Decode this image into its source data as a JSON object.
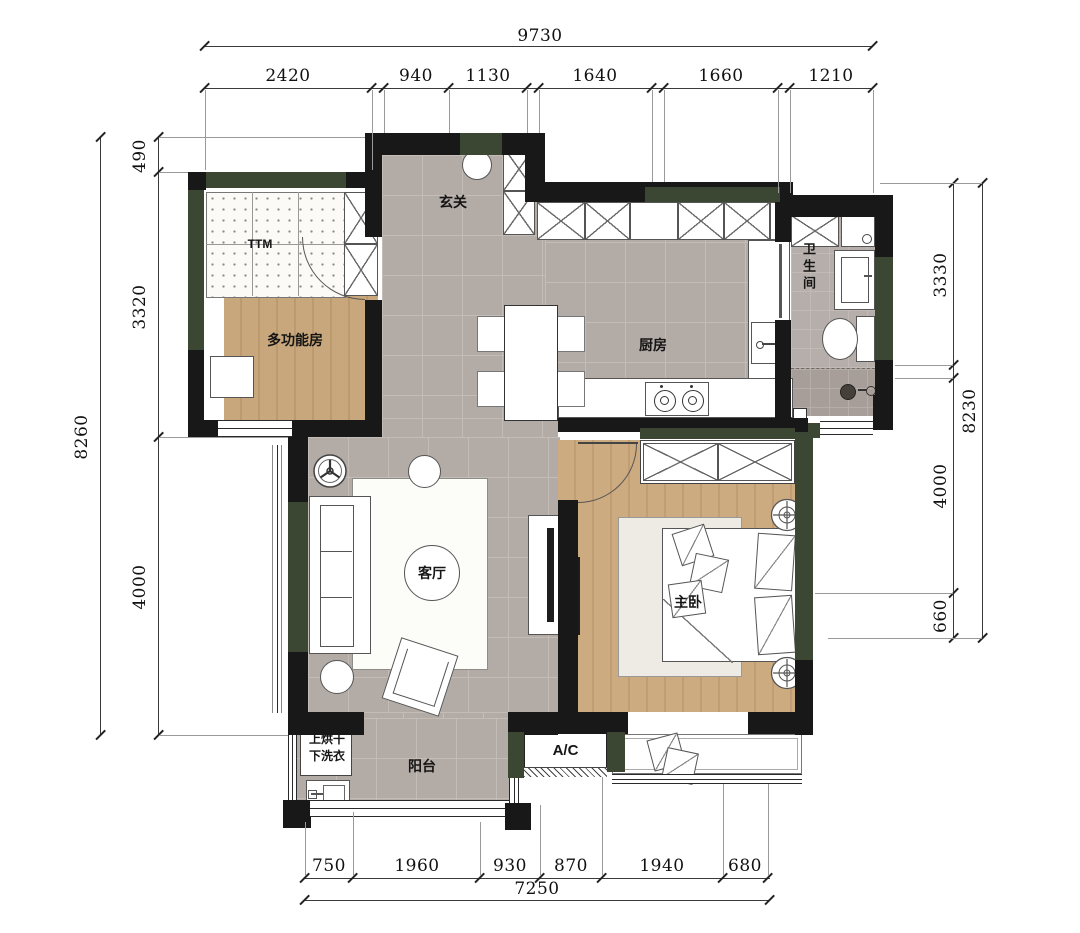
{
  "rooms": {
    "entry": "玄关",
    "multipurpose": "多功能房",
    "tatami": "TTM",
    "kitchen": "厨房",
    "bathroom": "卫生间",
    "living": "客厅",
    "master_bedroom": "主卧",
    "balcony": "阳台",
    "ac_platform": "A/C",
    "laundry_line1": "上烘干",
    "laundry_line2": "下洗衣"
  },
  "dimensions": {
    "top": {
      "total": "9730",
      "segments": [
        "2420",
        "940",
        "1130",
        "1640",
        "1660",
        "1210"
      ]
    },
    "left": {
      "total": "8260",
      "segments": [
        "490",
        "3320",
        "4000"
      ]
    },
    "right": {
      "total": "8230",
      "segments": [
        "3330",
        "4000",
        "660"
      ]
    },
    "bottom": {
      "total": "7250",
      "segments": [
        "750",
        "1960",
        "930",
        "870",
        "1940",
        "680"
      ]
    }
  },
  "colors": {
    "wall": "#181818",
    "outer_wall": "#3b4733",
    "tile_floor": "#b3aba6",
    "wood_floor": "#c9a77c",
    "bath_floor": "#b6aeab",
    "shower_floor": "#a79e9a"
  }
}
